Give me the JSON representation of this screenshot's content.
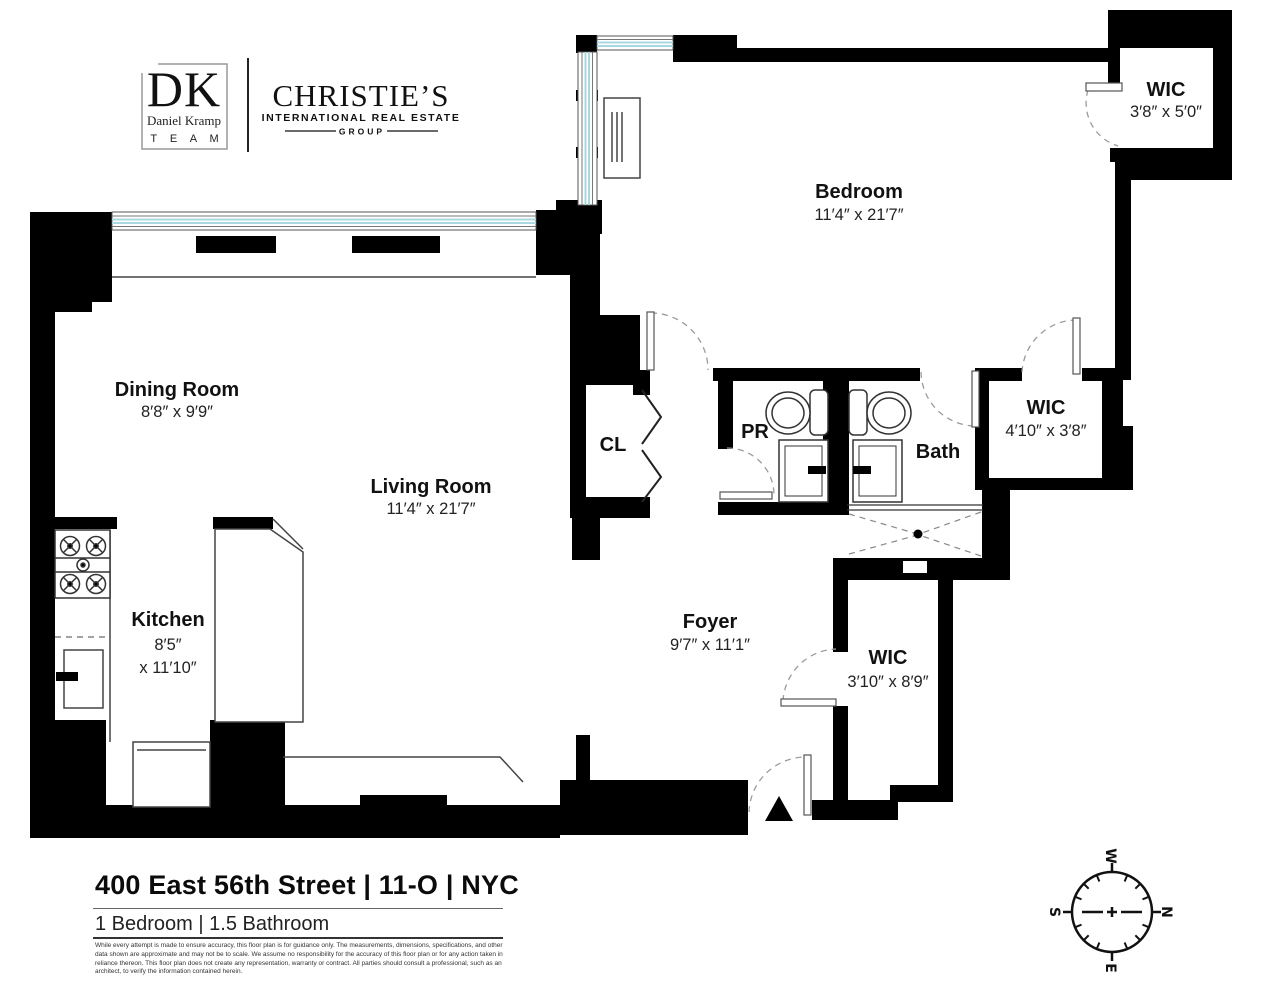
{
  "branding": {
    "dk_logo": {
      "initials": "DK",
      "name": "Daniel Kramp",
      "team": "T E A M"
    },
    "christies": {
      "title": "CHRISTIE’S",
      "subtitle": "INTERNATIONAL REAL ESTATE",
      "group": "GROUP"
    }
  },
  "rooms": {
    "bedroom": {
      "label": "Bedroom",
      "dims": "11′4″ x 21′7″"
    },
    "wic_top": {
      "label": "WIC",
      "dims": "3′8″ x 5′0″"
    },
    "dining": {
      "label": "Dining Room",
      "dims": "8′8″ x 9′9″"
    },
    "living": {
      "label": "Living Room",
      "dims": "11′4″ x 21′7″"
    },
    "closet": {
      "label": "CL"
    },
    "powder": {
      "label": "PR"
    },
    "bath": {
      "label": "Bath"
    },
    "wic_mid": {
      "label": "WIC",
      "dims": "4′10″ x 3′8″"
    },
    "kitchen": {
      "label": "Kitchen",
      "dims_line1": "8′5″",
      "dims_line2": "x 11′10″"
    },
    "foyer": {
      "label": "Foyer",
      "dims": "9′7″ x 11′1″"
    },
    "wic_bottom": {
      "label": "WIC",
      "dims": "3′10″ x 8′9″"
    }
  },
  "fixtures": [
    "stove-icon",
    "kitchen-sink-icon",
    "refrigerator-icon",
    "toilet-icon",
    "vanity-sink-icon",
    "shower-drain-icon",
    "entry-arrow-icon",
    "bifold-door-icon",
    "ptac-unit-icon"
  ],
  "compass": {
    "north": "N",
    "south": "S",
    "east": "E",
    "west": "W",
    "north_color": "#ee1c23"
  },
  "footer": {
    "address": "400 East 56th Street | 11-O | NYC",
    "summary": "1 Bedroom | 1.5 Bathroom",
    "disclaimer": "While every attempt is made to ensure accuracy, this floor plan is for guidance only. The measurements, dimensions, specifications, and other data shown are approximate and may not be to scale. We assume no responsibility for the accuracy of this floor plan or for any action taken in reliance thereon. This floor plan does not create any representation, warranty or contract. All parties should consult a professional, such as an architect, to verify the information contained herein."
  },
  "colors": {
    "wall": "#000000",
    "window_glass": "#a9d8e0",
    "door_arc": "#9a9a9a",
    "fixture_line": "#444444"
  }
}
